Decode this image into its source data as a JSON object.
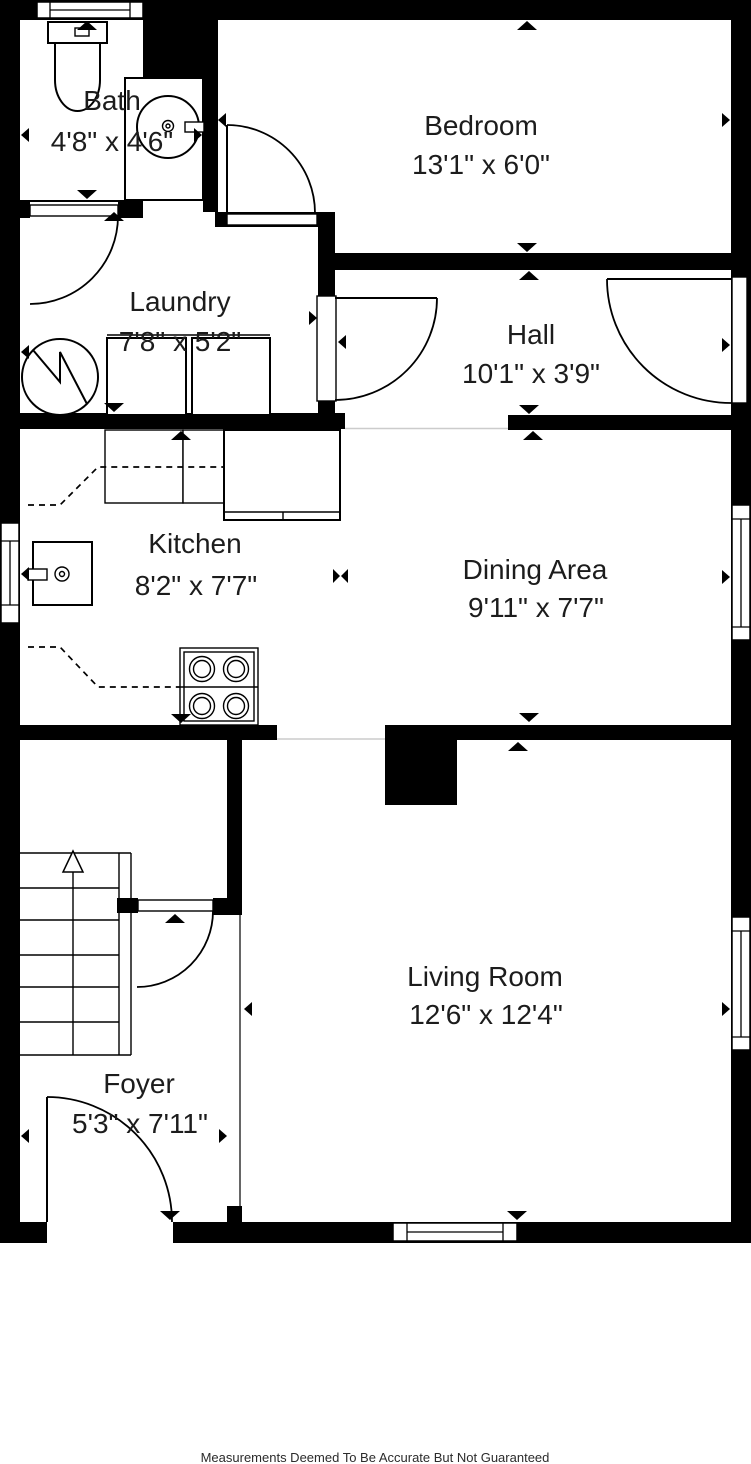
{
  "title": "Floor Plan",
  "colors": {
    "wall": "#000000",
    "line": "#1c1c1c",
    "background": "#ffffff",
    "threshold": "#cccccc"
  },
  "rooms": [
    {
      "name": "Bath",
      "dims": "4'8\" x 4'6\""
    },
    {
      "name": "Bedroom",
      "dims": "13'1\" x 6'0\""
    },
    {
      "name": "Laundry",
      "dims": "7'8\" x 5'2\""
    },
    {
      "name": "Hall",
      "dims": "10'1\" x 3'9\""
    },
    {
      "name": "Kitchen",
      "dims": "8'2\" x 7'7\""
    },
    {
      "name": "Dining Area",
      "dims": "9'11\" x 7'7\""
    },
    {
      "name": "Living Room",
      "dims": "12'6\" x 12'4\""
    },
    {
      "name": "Foyer",
      "dims": "5'3\" x 7'11\""
    }
  ],
  "fixtures": [
    "toilet",
    "bathroom-sink-vanity",
    "water-heater",
    "washer",
    "dryer",
    "kitchen-cabinets",
    "refrigerator",
    "kitchen-sink",
    "stove",
    "staircase",
    "chimney"
  ],
  "footer": {
    "disclaimer": "Measurements Deemed To Be Accurate But Not Guaranteed"
  }
}
